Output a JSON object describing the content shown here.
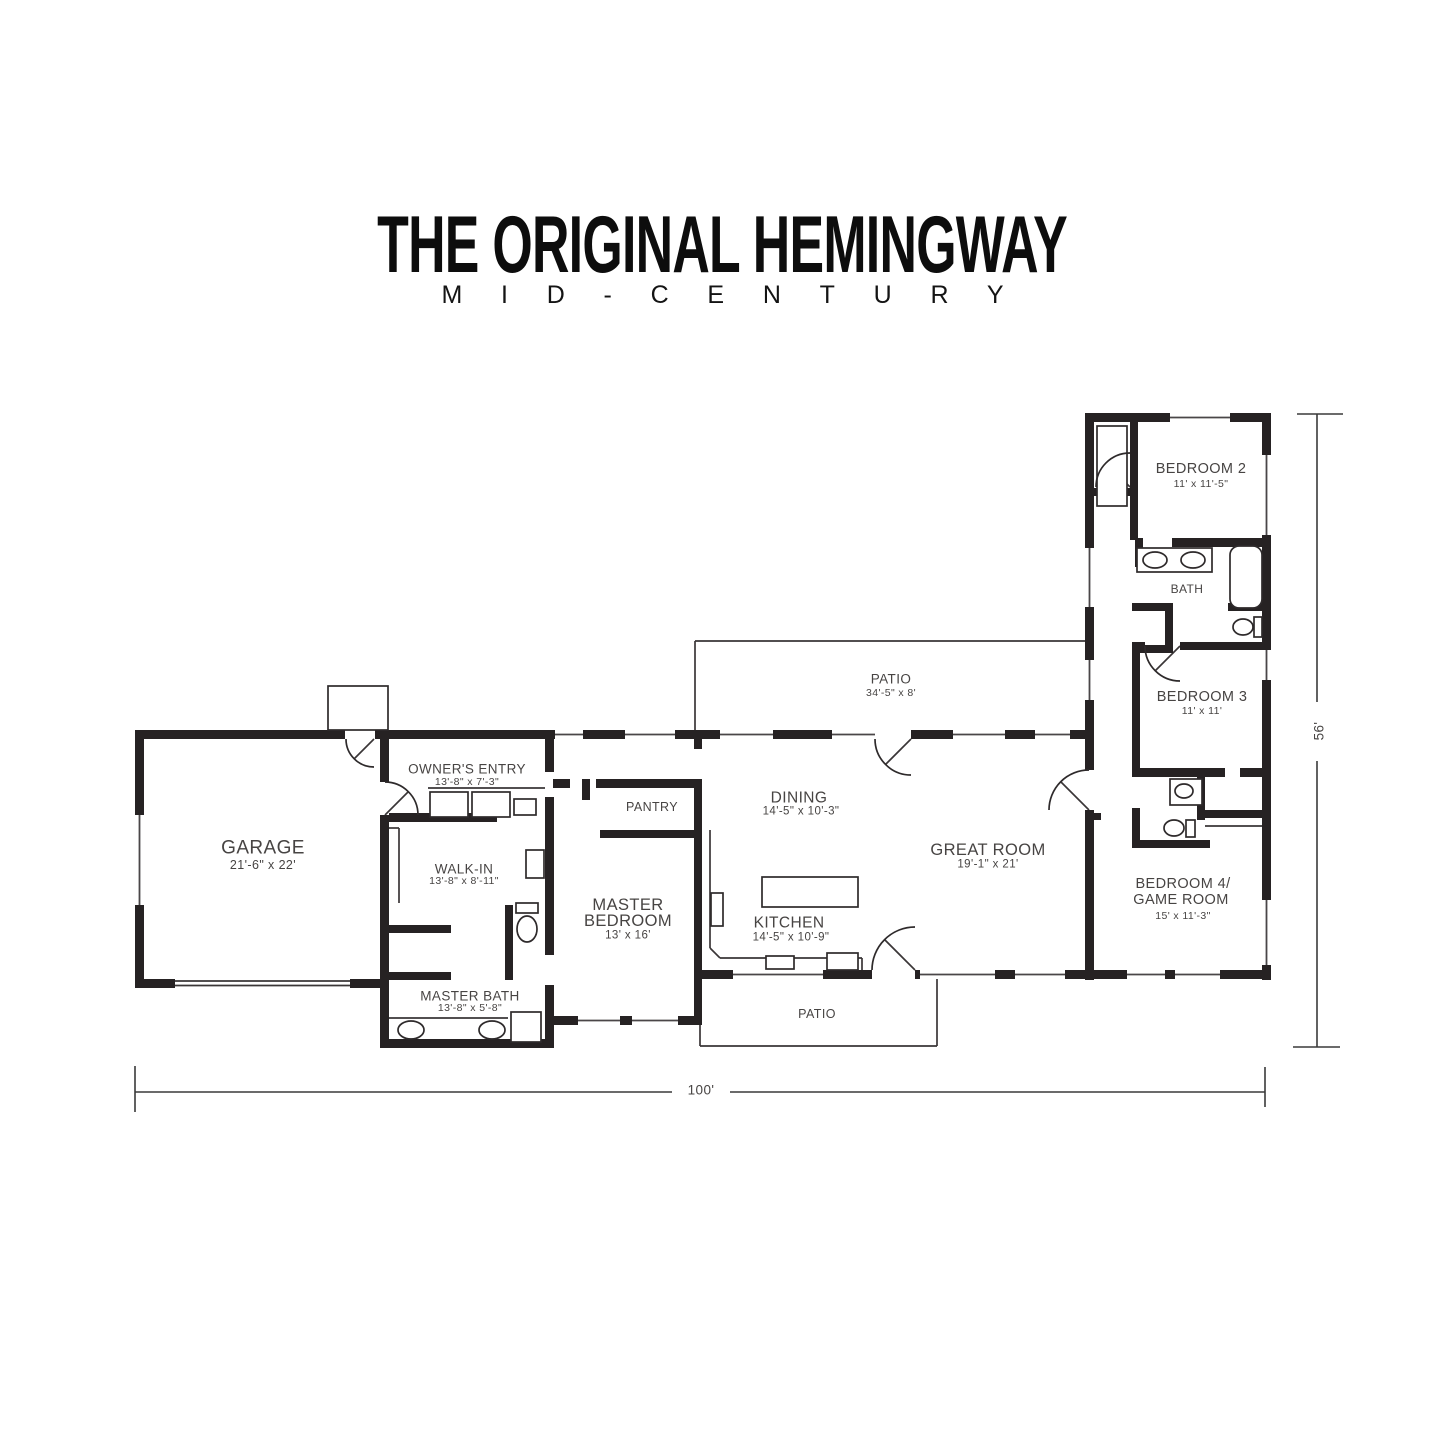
{
  "header": {
    "title": "THE ORIGINAL HEMINGWAY",
    "subtitle": "MID-CENTURY"
  },
  "rooms": {
    "garage": {
      "name": "GARAGE",
      "dims": "21'-6\" x 22'"
    },
    "owners_entry": {
      "name": "OWNER'S ENTRY",
      "dims": "13'-8\" x 7'-3\""
    },
    "walk_in": {
      "name": "WALK-IN",
      "dims": "13'-8\" x 8'-11\""
    },
    "master_bath": {
      "name": "MASTER BATH",
      "dims": "13'-8\" x 5'-8\""
    },
    "master_bedroom": {
      "name_line1": "MASTER",
      "name_line2": "BEDROOM",
      "dims": "13' x 16'"
    },
    "pantry": {
      "name": "PANTRY"
    },
    "dining": {
      "name": "DINING",
      "dims": "14'-5\" x 10'-3\""
    },
    "kitchen": {
      "name": "KITCHEN",
      "dims": "14'-5\" x 10'-9\""
    },
    "great_room": {
      "name": "GREAT ROOM",
      "dims": "19'-1\" x 21'"
    },
    "patio_rear": {
      "name": "PATIO",
      "dims": "34'-5\" x 8'"
    },
    "patio_front": {
      "name": "PATIO"
    },
    "bedroom_2": {
      "name": "BEDROOM 2",
      "dims": "11' x 11'-5\""
    },
    "bath": {
      "name": "BATH"
    },
    "bedroom_3": {
      "name": "BEDROOM 3",
      "dims": "11' x 11'"
    },
    "bedroom_4": {
      "name_line1": "BEDROOM 4/",
      "name_line2": "GAME ROOM",
      "dims": "15' x 11'-3\""
    }
  },
  "dimensions": {
    "overall_width": "100'",
    "overall_depth": "56'"
  },
  "colors": {
    "background": "#ffffff",
    "walls": "#262223",
    "labels": "#474443",
    "title": "#0d0d0d"
  }
}
